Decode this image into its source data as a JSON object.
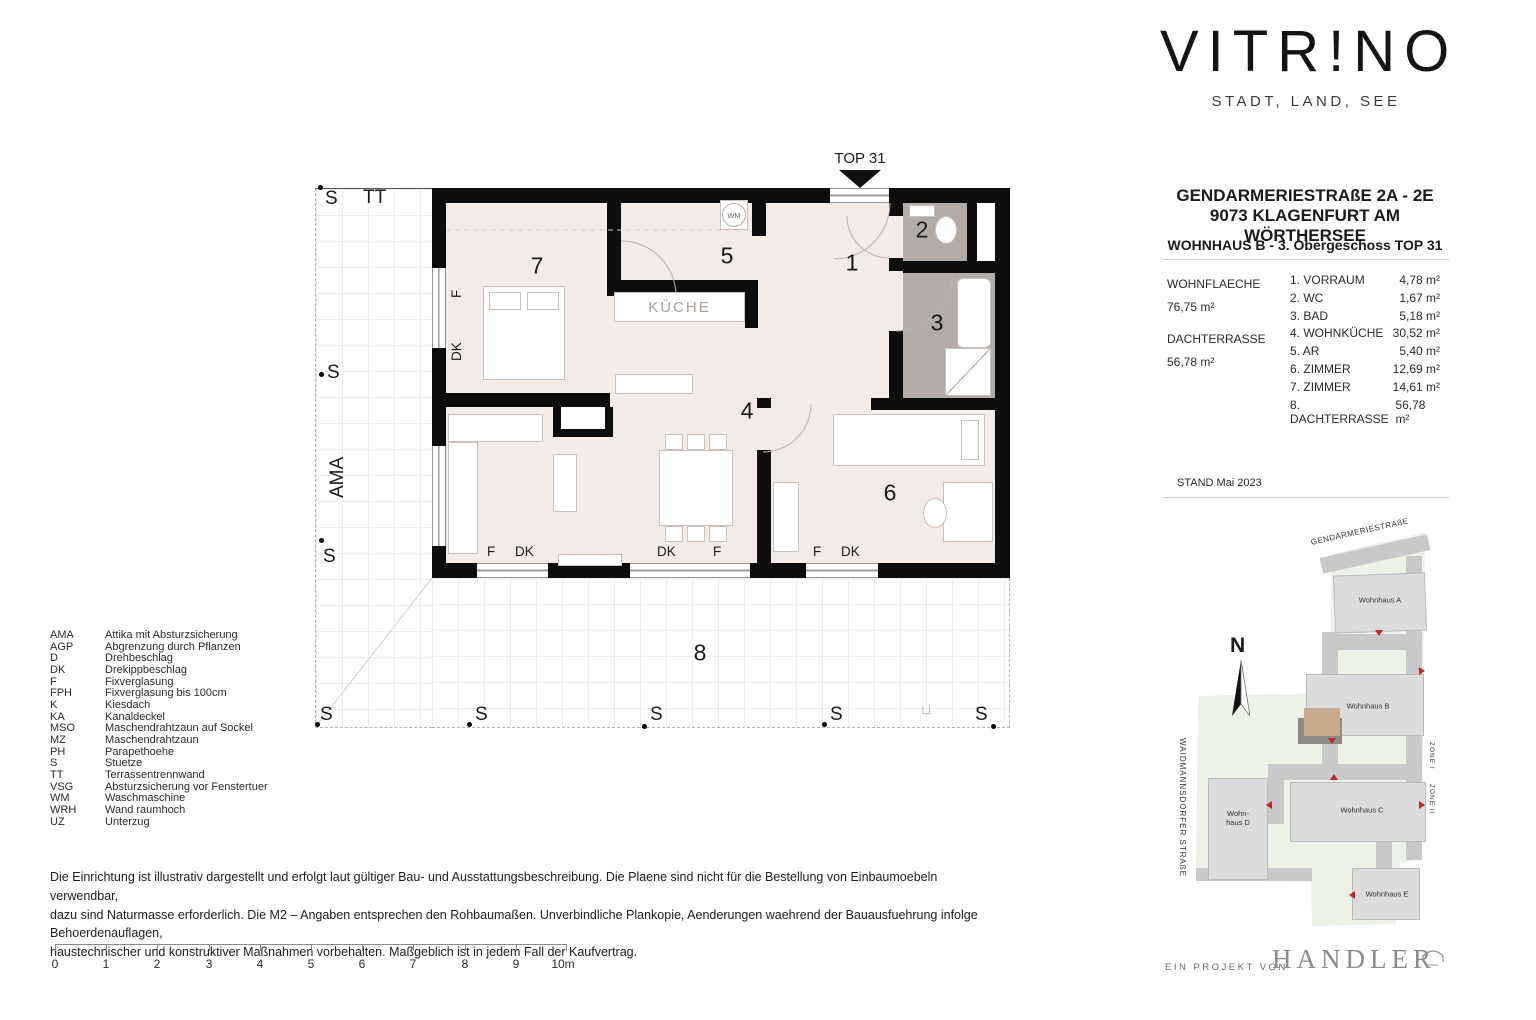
{
  "colors": {
    "wall": "#0d0d0d",
    "floor": "#f3ebe7",
    "wet_floor": "#b3aba7",
    "unit_highlight": "#c8a98c",
    "accent_red": "#c0272d"
  },
  "brand": {
    "logo_part1": "VITR",
    "logo_mark": "!",
    "logo_part2": "NO",
    "tagline": "STADT, LAND, SEE"
  },
  "header": {
    "address_line1": "GENDARMERIESTRAßE 2A - 2E",
    "address_line2": "9073 KLAGENFURT AM WÖRTHERSEE",
    "unit_title": "WOHNHAUS B - 3. Obergeschoss TOP 31"
  },
  "summary": {
    "living_label": "WOHNFLAECHE",
    "living_value": "76,75 m²",
    "terrace_label": "DACHTERRASSE",
    "terrace_value": "56,78 m²",
    "stand": "STAND Mai 2023"
  },
  "rooms": [
    {
      "no": "1.",
      "name": "VORRAUM",
      "area": "4,78 m²"
    },
    {
      "no": "2.",
      "name": "WC",
      "area": "1,67 m²"
    },
    {
      "no": "3.",
      "name": "BAD",
      "area": "5,18 m²"
    },
    {
      "no": "4.",
      "name": "WOHNKÜCHE",
      "area": "30,52 m²"
    },
    {
      "no": "5.",
      "name": "AR",
      "area": "5,40 m²"
    },
    {
      "no": "6.",
      "name": "ZIMMER",
      "area": "12,69 m²"
    },
    {
      "no": "7.",
      "name": "ZIMMER",
      "area": "14,61 m²"
    },
    {
      "no": "8.",
      "name": "DACHTERRASSE",
      "area": "56,78 m²"
    }
  ],
  "plan": {
    "top_marker": "TOP 31",
    "kueche": "KÜCHE",
    "wm": "WM",
    "s": "S",
    "tt": "TT",
    "ama": "AMA",
    "f": "F",
    "dk": "DK",
    "corner_symbol": "⊐",
    "numbers": {
      "n1": "1",
      "n2": "2",
      "n3": "3",
      "n4": "4",
      "n5": "5",
      "n6": "6",
      "n7": "7",
      "n8": "8"
    }
  },
  "legend": {
    "items": [
      {
        "abbr": "AMA",
        "text": "Attika mit Absturzsicherung"
      },
      {
        "abbr": "AGP",
        "text": "Abgrenzung durch Pflanzen"
      },
      {
        "abbr": "D",
        "text": "Drehbeschlag"
      },
      {
        "abbr": "DK",
        "text": "Drekippbeschlag"
      },
      {
        "abbr": "F",
        "text": "Fixverglasung"
      },
      {
        "abbr": "FPH",
        "text": "Fixverglasung bis 100cm"
      },
      {
        "abbr": "K",
        "text": "Kiesdach"
      },
      {
        "abbr": "KA",
        "text": "Kanaldeckel"
      },
      {
        "abbr": "MSO",
        "text": "Maschendrahtzaun auf Sockel"
      },
      {
        "abbr": "MZ",
        "text": "Maschendrahtzaun"
      },
      {
        "abbr": "PH",
        "text": "Parapethoehe"
      },
      {
        "abbr": "S",
        "text": "Stuetze"
      },
      {
        "abbr": "TT",
        "text": "Terrassentrennwand"
      },
      {
        "abbr": "VSG",
        "text": "Absturzsicherung vor Fenstertuer"
      },
      {
        "abbr": "WM",
        "text": "Waschmaschine"
      },
      {
        "abbr": "WRH",
        "text": "Wand raumhoch"
      },
      {
        "abbr": "UZ",
        "text": "Unterzug"
      }
    ]
  },
  "disclaimer": {
    "line1": "Die Einrichtung ist illustrativ dargestellt und erfolgt laut gültiger Bau- und Ausstattungsbeschreibung. Die Plaene sind nicht für die Bestellung von Einbaumoebeln verwendbar,",
    "line2": "dazu sind Naturmasse erforderlich. Die M2 – Angaben entsprechen den Rohbaumaßen. Unverbindliche Plankopie, Aenderungen waehrend der Bauausfuehrung infolge Behoerdenauflagen,",
    "line3": "haustechnischer und konstruktiver Maßnahmen vorbehalten. Maßgeblich ist in jedem Fall der Kaufvertrag."
  },
  "scalebar": {
    "labels": [
      "0",
      "1",
      "2",
      "3",
      "4",
      "5",
      "6",
      "7",
      "8",
      "9",
      "10m"
    ]
  },
  "sitemap": {
    "street_top": "GENDARMERIESTRAßE",
    "street_left": "WAIDMANNSDORFER STRAßE",
    "zone_1": "ZONE I",
    "zone_2": "ZONE II",
    "north": "N",
    "buildings": [
      {
        "label": "Wohnhaus A"
      },
      {
        "label": "Wohnhaus B"
      },
      {
        "label": "Wohnhaus C"
      },
      {
        "label": "Wohn-haus D"
      },
      {
        "label": "Wohnhaus E"
      }
    ]
  },
  "footer": {
    "prefix": "EIN PROJEKT VON",
    "brand": "HANDLER"
  }
}
